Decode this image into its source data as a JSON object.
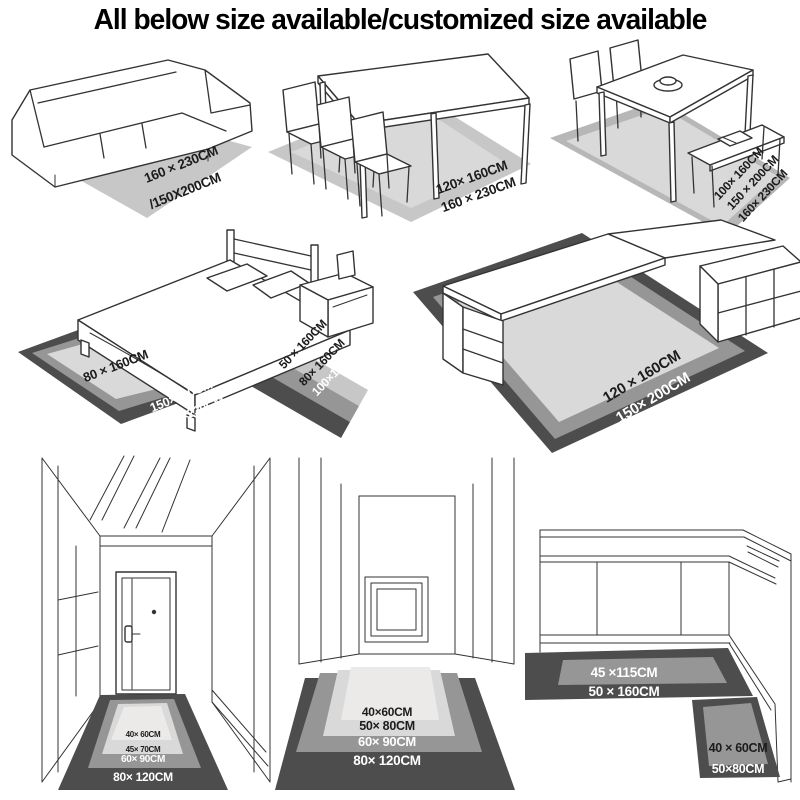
{
  "title": "All below size available/customized size available",
  "colors": {
    "background": "#ffffff",
    "rug_gray": "#c7c7c7",
    "rug_inner_light": "#d9d9d9",
    "rug_lightest": "#eceae8",
    "band_medium": "#969696",
    "band_dark": "#4d4d4d",
    "line_art": "#333333",
    "label_dark": "#1c1c1c",
    "label_white": "#ffffff"
  },
  "scenes": {
    "sofa": {
      "line1": "160 × 230CM",
      "line2": "/150X200CM"
    },
    "dining_table": {
      "line1": "120× 160CM",
      "line2": "160 × 230CM"
    },
    "dining_set": {
      "line1": "100× 160CM",
      "line2": "150 × 200CM",
      "line3": "160× 230CM"
    },
    "bed": {
      "rug_inner": "80 × 160CM",
      "rug_mid": "150×200CM",
      "rug_outer": "160×230CM",
      "runner_1": "50 × 160CM",
      "runner_2": "80× 160CM",
      "runner_3": "100×160CM"
    },
    "desk": {
      "line1": "120 × 160CM",
      "line2": "150× 200CM",
      "line3": "160× 230CM"
    },
    "hallway_door": {
      "mat1": "40× 60CM",
      "mat2": "45× 70CM",
      "mat3": "60× 90CM",
      "mat4": "80× 120CM"
    },
    "corridor": {
      "mat1": "40×60CM",
      "mat2": "50× 80CM",
      "mat3": "60× 90CM",
      "mat4": "80× 120CM"
    },
    "kitchen": {
      "runner_inner": "45 ×115CM",
      "runner_outer": "50 × 160CM",
      "mat_inner": "40 × 60CM",
      "mat_outer": "50×80CM"
    }
  }
}
